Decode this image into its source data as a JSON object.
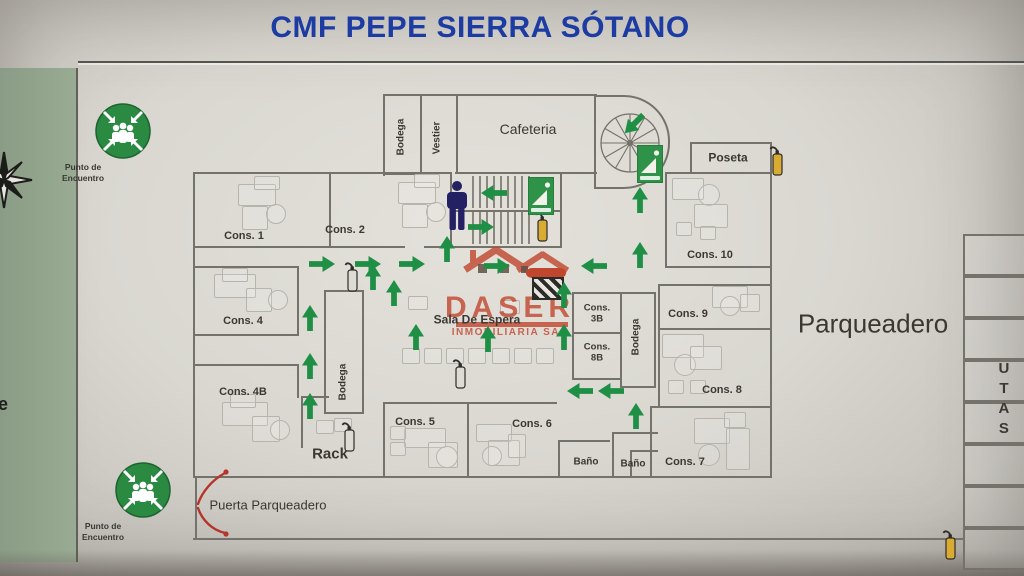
{
  "sign": {
    "title": "CMF PEPE SIERRA SÓTANO"
  },
  "side_strip": {
    "fragment_text": "e"
  },
  "colors": {
    "title_blue": "#1c3ca3",
    "route_green": "#1f8f45",
    "safety_green": "#2a8a41",
    "extinguisher_yellow": "#d9ab32",
    "watermark_red": "#c0462e",
    "wall_gray": "#75726b",
    "strip_green": "#93a58d",
    "door_arrow_red": "#b5342c"
  },
  "watermark": {
    "line1": "DASER",
    "line2": "INMOBILIARIA SAS"
  },
  "meeting_points": [
    {
      "label": "Punto de Encuentro",
      "cx": 123,
      "cy": 131
    },
    {
      "label": "Punto de Encuentro",
      "cx": 143,
      "cy": 490
    }
  ],
  "person": {
    "cx": 457,
    "cy": 206
  },
  "rooms": [
    {
      "id": "bodega-top",
      "label": "Bodega",
      "cx": 401,
      "cy": 137,
      "fs": 10,
      "mode": "rot"
    },
    {
      "id": "vestier",
      "label": "Vestier",
      "cx": 437,
      "cy": 138,
      "fs": 10,
      "mode": "rot"
    },
    {
      "id": "cafeteria",
      "label": "Cafeteria",
      "cx": 528,
      "cy": 130,
      "fs": 14,
      "weight": 500
    },
    {
      "id": "poseta",
      "label": "Poseta",
      "cx": 728,
      "cy": 158,
      "fs": 12
    },
    {
      "id": "cons-1",
      "label": "Cons. 1",
      "cx": 244,
      "cy": 236,
      "fs": 11
    },
    {
      "id": "cons-2",
      "label": "Cons. 2",
      "cx": 345,
      "cy": 230,
      "fs": 11
    },
    {
      "id": "cons-4",
      "label": "Cons. 4",
      "cx": 243,
      "cy": 321,
      "fs": 11
    },
    {
      "id": "cons-4b",
      "label": "Cons. 4B",
      "cx": 243,
      "cy": 392,
      "fs": 11
    },
    {
      "id": "cons-5",
      "label": "Cons. 5",
      "cx": 415,
      "cy": 422,
      "fs": 11
    },
    {
      "id": "cons-6",
      "label": "Cons. 6",
      "cx": 532,
      "cy": 424,
      "fs": 11
    },
    {
      "id": "cons-7",
      "label": "Cons. 7",
      "cx": 685,
      "cy": 462,
      "fs": 11
    },
    {
      "id": "cons-8",
      "label": "Cons. 8",
      "cx": 722,
      "cy": 390,
      "fs": 11
    },
    {
      "id": "cons-9",
      "label": "Cons. 9",
      "cx": 688,
      "cy": 314,
      "fs": 11
    },
    {
      "id": "cons-10",
      "label": "Cons. 10",
      "cx": 710,
      "cy": 255,
      "fs": 11
    },
    {
      "id": "cons-3b",
      "label": "Cons. 3B",
      "cx": 597,
      "cy": 314,
      "fs": 9.5,
      "mode": "wrap",
      "w": 34
    },
    {
      "id": "cons-8b",
      "label": "Cons. 8B",
      "cx": 597,
      "cy": 353,
      "fs": 9.5,
      "mode": "wrap",
      "w": 34
    },
    {
      "id": "bodega-mid",
      "label": "Bodega",
      "cx": 343,
      "cy": 382,
      "fs": 10,
      "mode": "rot"
    },
    {
      "id": "bodega-right",
      "label": "Bodega",
      "cx": 636,
      "cy": 337,
      "fs": 10,
      "mode": "rot"
    },
    {
      "id": "sala-espera",
      "label": "Sala De Espera",
      "cx": 477,
      "cy": 320,
      "fs": 12,
      "weight": 700
    },
    {
      "id": "rack",
      "label": "Rack",
      "cx": 330,
      "cy": 455,
      "fs": 15
    },
    {
      "id": "bano-1",
      "label": "Baño",
      "cx": 586,
      "cy": 462,
      "fs": 10,
      "weight": 700
    },
    {
      "id": "bano-2",
      "label": "Baño",
      "cx": 633,
      "cy": 464,
      "fs": 10,
      "weight": 700
    },
    {
      "id": "puerta-parqueadero",
      "label": "Puerta Parqueadero",
      "cx": 268,
      "cy": 506,
      "fs": 13,
      "mode": "wrap",
      "w": 120,
      "weight": 500
    },
    {
      "id": "parqueadero",
      "label": "Parqueadero",
      "cx": 873,
      "cy": 324,
      "fs": 26,
      "weight": 400
    },
    {
      "id": "utas",
      "label": "UTAS",
      "cx": 1003,
      "cy": 400,
      "fs": 15,
      "mode": "vert"
    }
  ],
  "route_arrows": [
    {
      "d": "right",
      "cx": 322,
      "cy": 264
    },
    {
      "d": "right",
      "cx": 368,
      "cy": 264
    },
    {
      "d": "right",
      "cx": 412,
      "cy": 264
    },
    {
      "d": "right",
      "cx": 497,
      "cy": 266
    },
    {
      "d": "left",
      "cx": 594,
      "cy": 266
    },
    {
      "d": "left",
      "cx": 580,
      "cy": 391
    },
    {
      "d": "left",
      "cx": 611,
      "cy": 391
    },
    {
      "d": "up",
      "cx": 310,
      "cy": 318
    },
    {
      "d": "up",
      "cx": 310,
      "cy": 366
    },
    {
      "d": "up",
      "cx": 310,
      "cy": 406
    },
    {
      "d": "up",
      "cx": 373,
      "cy": 277
    },
    {
      "d": "up",
      "cx": 394,
      "cy": 293
    },
    {
      "d": "up",
      "cx": 416,
      "cy": 337
    },
    {
      "d": "up",
      "cx": 447,
      "cy": 249
    },
    {
      "d": "up",
      "cx": 488,
      "cy": 339
    },
    {
      "d": "up",
      "cx": 564,
      "cy": 295
    },
    {
      "d": "up",
      "cx": 564,
      "cy": 337
    },
    {
      "d": "up",
      "cx": 640,
      "cy": 200
    },
    {
      "d": "up",
      "cx": 640,
      "cy": 255
    },
    {
      "d": "up",
      "cx": 636,
      "cy": 416
    },
    {
      "d": "left",
      "cx": 494,
      "cy": 193
    },
    {
      "d": "right",
      "cx": 481,
      "cy": 227
    },
    {
      "d": "downleft",
      "cx": 634,
      "cy": 124
    }
  ],
  "extinguishers": [
    {
      "variant": "yellow",
      "cx": 542,
      "cy": 227
    },
    {
      "variant": "yellow",
      "cx": 777,
      "cy": 161
    },
    {
      "variant": "yellow",
      "cx": 950,
      "cy": 545
    },
    {
      "variant": "gray",
      "cx": 352,
      "cy": 277
    },
    {
      "variant": "gray",
      "cx": 460,
      "cy": 374
    },
    {
      "variant": "gray",
      "cx": 349,
      "cy": 437
    }
  ],
  "exit_signs": [
    {
      "cx": 541,
      "cy": 196
    },
    {
      "cx": 650,
      "cy": 164
    }
  ]
}
